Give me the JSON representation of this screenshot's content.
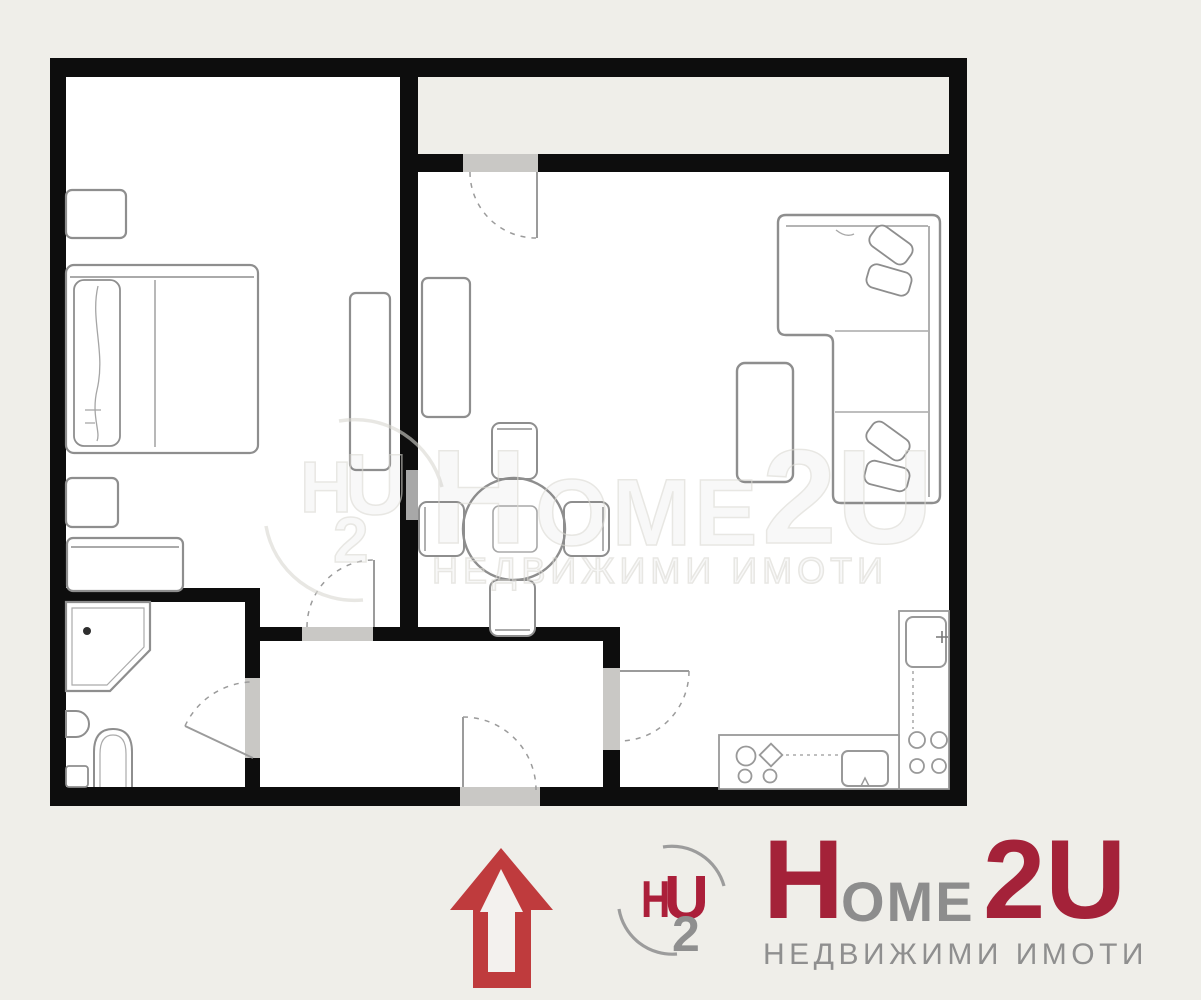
{
  "page": {
    "background": "#efeee9"
  },
  "floor_plan": {
    "wall_color": "#0d0d0d",
    "room_fill": "#ffffff",
    "balcony_fill": "#efeee9",
    "door_opening_color": "#c9c8c5",
    "furniture_outline_color": "#8e8e8e",
    "rooms": [
      "bedroom",
      "living-dining-room",
      "kitchen-corner",
      "bathroom",
      "hallway",
      "balcony"
    ],
    "fixture_icons": [
      "bed-icon",
      "pillow-icon",
      "nightstand-icon",
      "storage-box-icon",
      "dresser-icon",
      "wardrobe-icon",
      "cabinet-icon",
      "round-dining-table-icon",
      "chair-icon",
      "corner-sofa-icon",
      "sofa-cushion-icon",
      "side-table-icon",
      "corner-shower-icon",
      "wash-basin-icon",
      "toilet-icon",
      "kitchen-counter-icon",
      "cooktop-burners-icon",
      "kitchen-sink-icon",
      "door-swing-arc-icon",
      "door-leaf-icon"
    ]
  },
  "watermark": {
    "monogram": {
      "h": "H",
      "two": "2",
      "u": "U"
    },
    "wordmark": {
      "h": "H",
      "ome": "OME",
      "two_u": "2U"
    },
    "tagline": "НЕДВИЖИМИ ИМОТИ"
  },
  "branding": {
    "arrow_color": "#bf3b3d",
    "logo": {
      "h": "H",
      "u": "U",
      "two": "2",
      "red": "#ab1f3a",
      "gray": "#8f8f8f",
      "arc_color": "#9c9c9c"
    },
    "wordmark": {
      "h": "H",
      "ome": "OME",
      "two_u": "2U",
      "red": "#a42239",
      "gray": "#8d8d8d"
    },
    "tagline": "НЕДВИЖИМИ ИМОТИ",
    "tagline_color": "#8f8f8f"
  }
}
